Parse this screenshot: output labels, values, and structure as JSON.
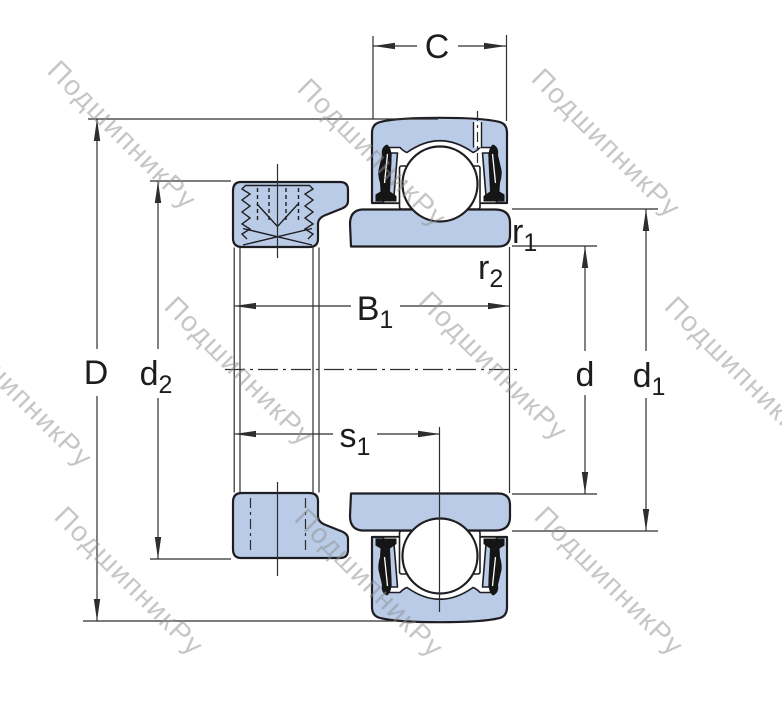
{
  "drawing": {
    "kind": "insert-ball-bearing-cross-section"
  },
  "watermark": {
    "text": "ПодшипникРу"
  },
  "dimensions": {
    "C": {
      "base": "C",
      "sub": ""
    },
    "D": {
      "base": "D",
      "sub": ""
    },
    "d2": {
      "base": "d",
      "sub": "2"
    },
    "B1": {
      "base": "B",
      "sub": "1"
    },
    "s1": {
      "base": "s",
      "sub": "1"
    },
    "d": {
      "base": "d",
      "sub": ""
    },
    "d1": {
      "base": "d",
      "sub": "1"
    },
    "r1": {
      "base": "r",
      "sub": "1"
    },
    "r2": {
      "base": "r",
      "sub": "2"
    }
  },
  "colors": {
    "part_fill": "#b9cbe6",
    "outline": "#1e1e22",
    "dim_line": "#2e2e2e",
    "seal": "#151515",
    "watermark": "#8f8f8f",
    "background": "#ffffff"
  }
}
